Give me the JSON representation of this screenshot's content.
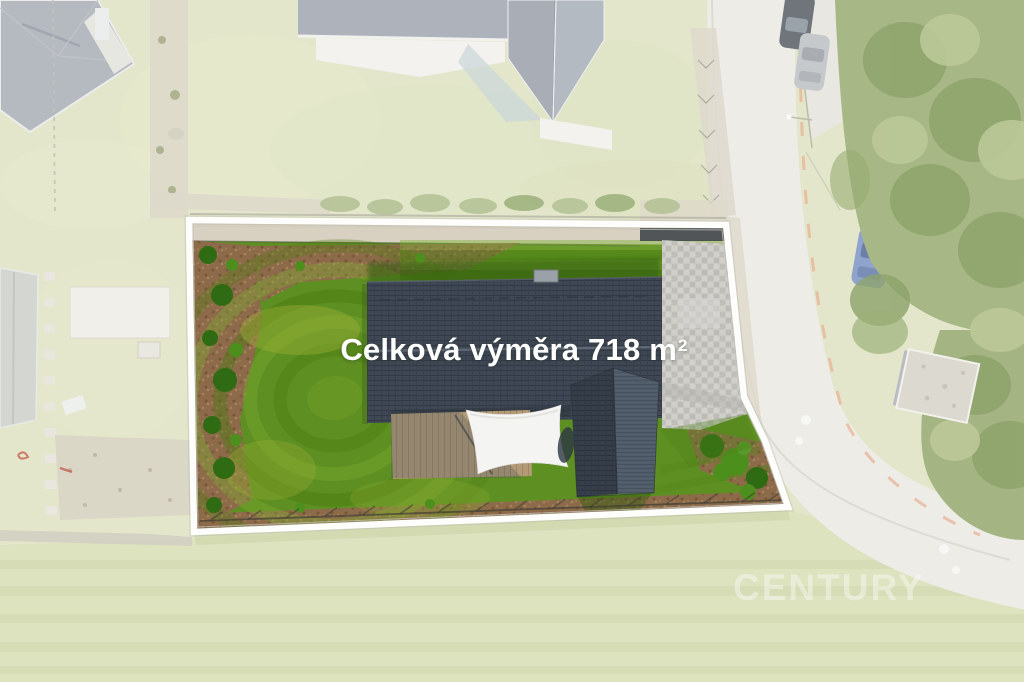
{
  "overlay": {
    "area_label": "Celková výměra 718 m",
    "area_label_sup": "2"
  },
  "watermark": {
    "brand": "CENTURY"
  },
  "scene": {
    "description": "Aerial drone photo of a house plot highlighted in full color inside a white boundary; surrounding neighbourhood, road and field are faded toward white",
    "colors": {
      "lawn_green": "#5e8f22",
      "roof_slate": "#3e4753",
      "boundary_white": "#fdfdfb",
      "mulch_brown": "#8d6b4a",
      "paving_gray": "#c9c8c3",
      "deck_wood": "#b49b77",
      "faded_grass": "#e3e6cb",
      "road_asphalt": "#edebe5",
      "sail_white": "#f4f4f2"
    }
  }
}
